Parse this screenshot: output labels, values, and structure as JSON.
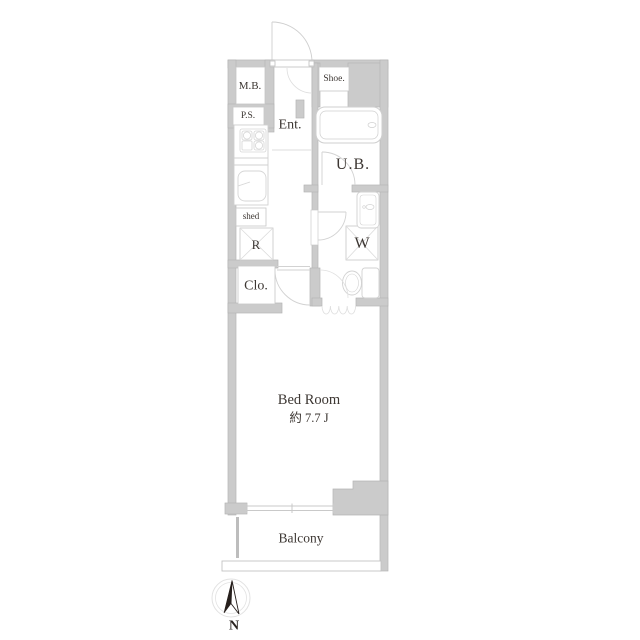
{
  "floorplan": {
    "labels": {
      "meter_box": "M.B.",
      "pipe_space": "P.S.",
      "entrance": "Ent.",
      "shoe_box": "Shoe.",
      "unit_bath": "U.B.",
      "shed": "shed",
      "refrigerator": "R",
      "closet": "Clo.",
      "washer": "W",
      "bedroom_name": "Bed Room",
      "bedroom_size": "約 7.7 J",
      "balcony": "Balcony",
      "compass_north": "N"
    },
    "colors": {
      "wall_fill": "#cbcbcb",
      "wall_edge": "#b5b5b5",
      "fixture_line": "#d6d6d6",
      "door_arc": "#d2d2d2",
      "text": "#3d3733",
      "compass_needle": "#261f1c",
      "background": "#ffffff"
    }
  }
}
